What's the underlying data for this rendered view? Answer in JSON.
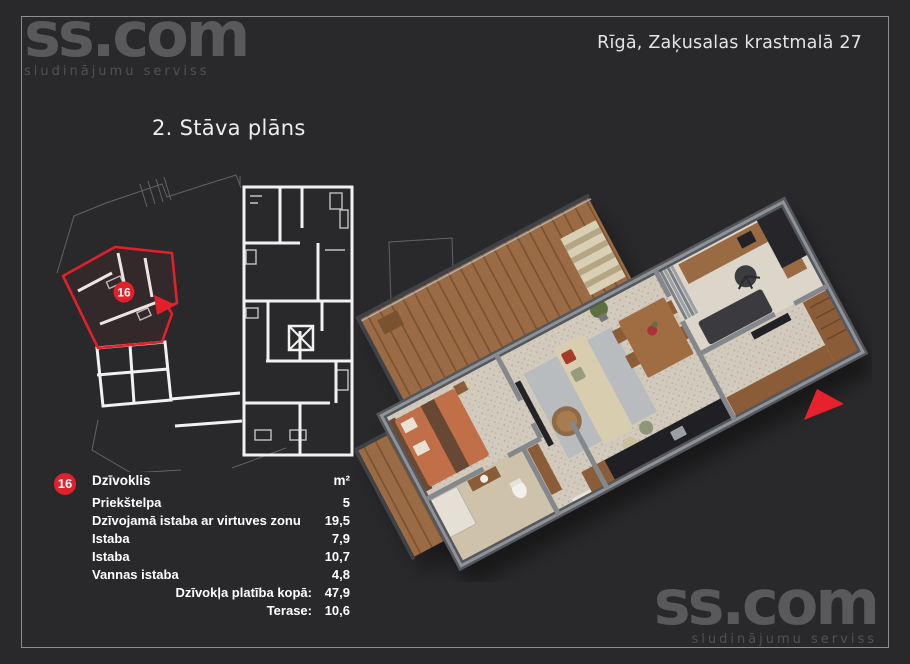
{
  "page": {
    "background": "#29292b",
    "frame_color": "#8e8e91",
    "accent_color": "#e2202a"
  },
  "brand": {
    "name": "ss.com",
    "tagline": "sludinājumu serviss"
  },
  "header": {
    "address": "Rīgā, Zaķusalas krastmalā 27"
  },
  "plan": {
    "title": "2. Stāva plāns",
    "unit_number": "16"
  },
  "table": {
    "unit_number": "16",
    "header": {
      "label": "Dzīvoklis",
      "unit": "m²"
    },
    "rows": [
      {
        "label": "Priekštelpa",
        "value": "5"
      },
      {
        "label": "Dzīvojamā istaba ar virtuves zonu",
        "value": "19,5"
      },
      {
        "label": "Istaba",
        "value": "7,9"
      },
      {
        "label": "Istaba",
        "value": "10,7"
      },
      {
        "label": "Vannas istaba",
        "value": "4,8"
      }
    ],
    "totals": [
      {
        "label": "Dzīvokļa platība kopā:",
        "value": "47,9"
      },
      {
        "label": "Terase:",
        "value": "10,6"
      }
    ]
  },
  "footer": {
    "name": "ss.com",
    "tagline": "sludinājumu serviss"
  }
}
